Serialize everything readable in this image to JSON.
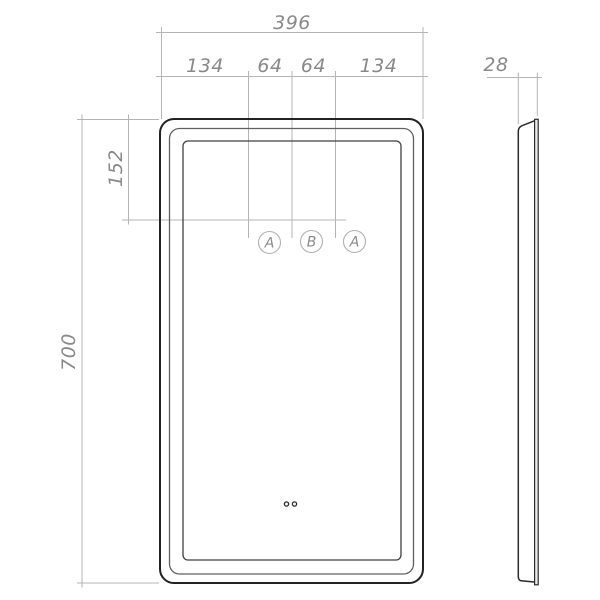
{
  "drawing": {
    "dims": {
      "overall_width": "396",
      "seg_left": "134",
      "seg_mid_left": "64",
      "seg_mid_right": "64",
      "seg_right": "134",
      "depth": "28",
      "sensor_offset": "152",
      "overall_height": "700"
    },
    "sensors": {
      "left": "A",
      "center": "B",
      "right": "A"
    },
    "colors": {
      "outline": "#2b2b2b",
      "dim_line": "#b4b4b4",
      "dim_text": "#898989"
    }
  }
}
